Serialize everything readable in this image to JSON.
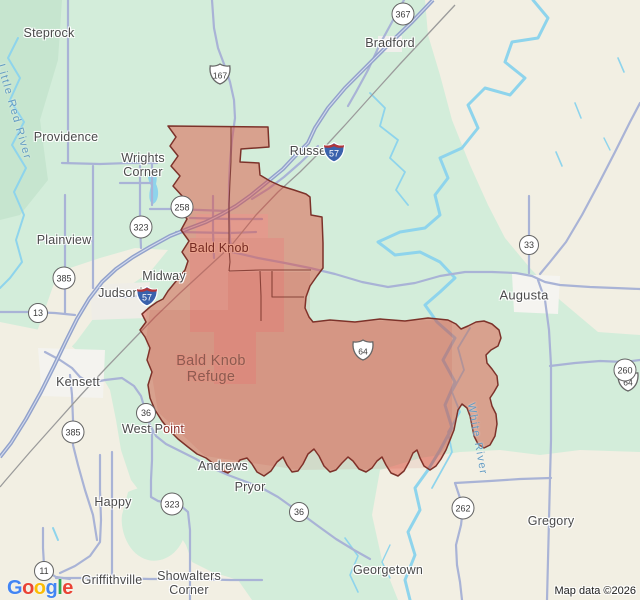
{
  "map": {
    "region_name": "Bald Knob Refuge",
    "colors": {
      "land_green": "#d3edda",
      "forest_green": "#c6e5cf",
      "terrain_beige": "#f2efe3",
      "water_blue": "#8ed4ec",
      "road": "#a9b3d6",
      "freeway": "#92a2cb",
      "overlay_fill": "rgba(224,64,45,0.44)",
      "overlay_stroke": "#7c322a"
    }
  },
  "labels": [
    {
      "name": "steprock",
      "text": "Steprock",
      "x": 49,
      "y": 33,
      "cls": ""
    },
    {
      "name": "bradford",
      "text": "Bradford",
      "x": 390,
      "y": 43,
      "cls": ""
    },
    {
      "name": "providence",
      "text": "Providence",
      "x": 66,
      "y": 137,
      "cls": ""
    },
    {
      "name": "wrights-corner",
      "lines": [
        "Wrights",
        "Corner"
      ],
      "x": 143,
      "y": 165,
      "cls": ""
    },
    {
      "name": "russell",
      "text": "Russell",
      "x": 311,
      "y": 151,
      "cls": ""
    },
    {
      "name": "plainview",
      "text": "Plainview",
      "x": 64,
      "y": 240,
      "cls": ""
    },
    {
      "name": "midway",
      "text": "Midway",
      "x": 164,
      "y": 276,
      "cls": ""
    },
    {
      "name": "judsonia",
      "text": "Judsonia",
      "x": 124,
      "y": 293,
      "cls": ""
    },
    {
      "name": "bald-knob",
      "text": "Bald Knob",
      "x": 219,
      "y": 248,
      "cls": "town-tinted"
    },
    {
      "name": "augusta",
      "text": "Augusta",
      "x": 524,
      "y": 296,
      "cls": "big"
    },
    {
      "name": "kensett",
      "text": "Kensett",
      "x": 78,
      "y": 382,
      "cls": ""
    },
    {
      "name": "west-point",
      "parts": [
        {
          "t": "West P",
          "c": "#4a4a4a"
        },
        {
          "t": "oint",
          "c": "#8d2f28"
        }
      ],
      "x": 153,
      "y": 429,
      "cls": "inline"
    },
    {
      "name": "bald-knob-refuge",
      "lines": [
        "Bald Knob",
        "Refuge"
      ],
      "x": 211,
      "y": 369,
      "cls": "refuge"
    },
    {
      "name": "andrews",
      "text": "Andrews",
      "x": 223,
      "y": 466,
      "cls": ""
    },
    {
      "name": "pryor",
      "text": "Pryor",
      "x": 250,
      "y": 487,
      "cls": ""
    },
    {
      "name": "happy",
      "text": "Happy",
      "x": 113,
      "y": 502,
      "cls": ""
    },
    {
      "name": "gregory",
      "text": "Gregory",
      "x": 551,
      "y": 521,
      "cls": ""
    },
    {
      "name": "georgetown",
      "text": "Georgetown",
      "x": 388,
      "y": 570,
      "cls": ""
    },
    {
      "name": "griffithville",
      "text": "Griffithville",
      "x": 112,
      "y": 580,
      "cls": ""
    },
    {
      "name": "showalters-corner",
      "lines": [
        "Showalters",
        "Corner"
      ],
      "x": 189,
      "y": 583,
      "cls": ""
    },
    {
      "name": "little-red-river",
      "text": "Little Red River",
      "x": 14,
      "y": 112,
      "cls": "water",
      "rot": 74
    },
    {
      "name": "white-river",
      "text": "White River",
      "x": 477,
      "y": 439,
      "cls": "water",
      "rot": 80
    }
  ],
  "shields": [
    {
      "type": "circle",
      "label": "367",
      "x": 403,
      "y": 14
    },
    {
      "type": "us",
      "label": "167",
      "x": 220,
      "y": 74
    },
    {
      "type": "interstate",
      "label": "57",
      "x": 334,
      "y": 129
    },
    {
      "type": "interstate",
      "label": "57",
      "x": 147,
      "y": 250
    },
    {
      "type": "circle",
      "label": "258",
      "x": 182,
      "y": 207
    },
    {
      "type": "circle",
      "label": "323",
      "x": 141,
      "y": 227
    },
    {
      "type": "circle",
      "label": "385",
      "x": 64,
      "y": 278
    },
    {
      "type": "circle",
      "label": "13",
      "x": 38,
      "y": 313
    },
    {
      "type": "us",
      "label": "64",
      "x": 363,
      "y": 281
    },
    {
      "type": "us",
      "label": "64",
      "x": 628,
      "y": 289
    },
    {
      "type": "circle",
      "label": "33",
      "x": 529,
      "y": 245
    },
    {
      "type": "circle",
      "label": "260",
      "x": 625,
      "y": 370
    },
    {
      "type": "circle",
      "label": "385",
      "x": 73,
      "y": 432
    },
    {
      "type": "circle",
      "label": "36",
      "x": 146,
      "y": 413
    },
    {
      "type": "circle",
      "label": "36",
      "x": 299,
      "y": 512
    },
    {
      "type": "circle",
      "label": "323",
      "x": 172,
      "y": 504
    },
    {
      "type": "circle",
      "label": "11",
      "x": 44,
      "y": 571
    },
    {
      "type": "circle",
      "label": "262",
      "x": 463,
      "y": 508
    }
  ],
  "logo": {
    "letters": [
      {
        "ch": "G",
        "c": "#4285F4"
      },
      {
        "ch": "o",
        "c": "#EA4335"
      },
      {
        "ch": "o",
        "c": "#FBBC05"
      },
      {
        "ch": "g",
        "c": "#4285F4"
      },
      {
        "ch": "l",
        "c": "#34A853"
      },
      {
        "ch": "e",
        "c": "#EA4335"
      }
    ]
  },
  "attribution": {
    "text": "Map data ©2026"
  }
}
